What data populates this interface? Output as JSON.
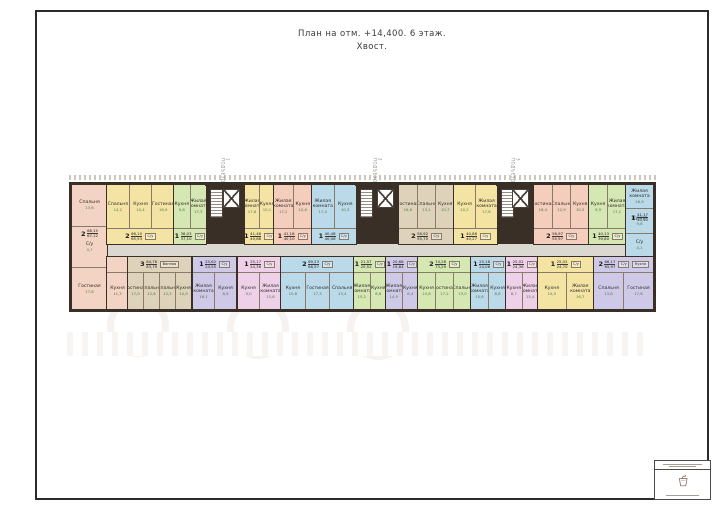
{
  "page": {
    "title_line1": "План на отм. +14,400. 6 этаж.",
    "title_line2": "Хвост."
  },
  "colors": {
    "wall": "#3a2f27",
    "partition": "#8a7a6a",
    "corridor": "#dbd8d2",
    "lobby": "#e7e4de",
    "pink": "#f3d3c3",
    "salmon": "#f4cdbc",
    "yellow": "#f4e4a4",
    "green": "#d5e7b2",
    "blue": "#bad9e9",
    "tan": "#ded3ba",
    "lavender": "#cfc9e8",
    "magenta": "#eed1e9"
  },
  "building": {
    "corridor": {
      "x": 35,
      "y": 59,
      "w": 521,
      "h": 13
    },
    "units": [
      {
        "t": "corner",
        "x": 0,
        "w": 35,
        "h": 124,
        "color": "pink",
        "ly": 44,
        "stack": [
          {
            "n": "Спальня",
            "a": "13,6"
          },
          {
            "n": "С/у",
            "a": "4,7"
          },
          {
            "n": "Гостиная",
            "a": "17,8"
          }
        ],
        "label": {
          "n": "2",
          "a1": "68,15",
          "a2": "67,12"
        }
      },
      {
        "t": "top",
        "x": 35,
        "w": 67,
        "color": "yellow",
        "rooms": [
          {
            "n": "Спальня",
            "a": "14,2"
          },
          {
            "n": "Кухня",
            "a": "10,4"
          },
          {
            "n": "Гостиная",
            "a": "16,9"
          }
        ],
        "chips": [
          "С/у"
        ],
        "label": {
          "n": "2",
          "a1": "66,10",
          "a2": "65,53"
        }
      },
      {
        "t": "top",
        "x": 102,
        "w": 32,
        "color": "green",
        "rooms": [
          {
            "n": "Кухня",
            "a": "9,8"
          },
          {
            "n": "Жилая комната",
            "a": "17,3"
          }
        ],
        "chips": [
          "С/у"
        ],
        "label": {
          "n": "1",
          "a1": "38,03",
          "a2": "37,10"
        }
      },
      {
        "t": "core",
        "x": 134,
        "w": 39,
        "entrance": "1 ПОДЪЕЗД"
      },
      {
        "t": "top",
        "x": 173,
        "w": 29,
        "color": "yellow",
        "rooms": [
          {
            "n": "Жилая комната",
            "a": "17,6"
          },
          {
            "n": "Кухня",
            "a": "10,1"
          }
        ],
        "chips": [
          "С/у"
        ],
        "label": {
          "n": "1",
          "a1": "41,46",
          "a2": "40,86"
        }
      },
      {
        "t": "top",
        "x": 202,
        "w": 38,
        "color": "salmon",
        "rooms": [
          {
            "n": "Жилая комната",
            "a": "17,2"
          },
          {
            "n": "Кухня",
            "a": "10,6"
          }
        ],
        "chips": [
          "С/у"
        ],
        "label": {
          "n": "1",
          "a1": "41,18",
          "a2": "40,10"
        }
      },
      {
        "t": "top",
        "x": 240,
        "w": 44,
        "color": "blue",
        "rooms": [
          {
            "n": "Жилая комната",
            "a": "17,4"
          },
          {
            "n": "Кухня",
            "a": "10,3"
          }
        ],
        "chips": [
          "С/у"
        ],
        "label": {
          "n": "1",
          "a1": "40,48",
          "a2": "40,06"
        }
      },
      {
        "t": "core",
        "x": 284,
        "w": 43,
        "entrance": "2 ПОДЪЕЗД"
      },
      {
        "t": "top",
        "x": 327,
        "w": 55,
        "color": "tan",
        "rooms": [
          {
            "n": "Гостиная",
            "a": "16,6"
          },
          {
            "n": "Спальня",
            "a": "13,1"
          },
          {
            "n": "Кухня",
            "a": "10,7"
          }
        ],
        "chips": [
          "С/у"
        ],
        "label": {
          "n": "2",
          "a1": "56,92",
          "a2": "55,70"
        }
      },
      {
        "t": "top",
        "x": 382,
        "w": 43,
        "color": "yellow",
        "rooms": [
          {
            "n": "Кухня",
            "a": "10,2"
          },
          {
            "n": "Жилая комната",
            "a": "17,8"
          }
        ],
        "chips": [
          "С/у"
        ],
        "label": {
          "n": "1",
          "a1": "40,86",
          "a2": "40,27"
        }
      },
      {
        "t": "core",
        "x": 425,
        "w": 37,
        "entrance": "3 ПОДЪЕЗД"
      },
      {
        "t": "top",
        "x": 462,
        "w": 55,
        "color": "salmon",
        "rooms": [
          {
            "n": "Гостиная",
            "a": "16,4"
          },
          {
            "n": "Спальня",
            "a": "12,9"
          },
          {
            "n": "Кухня",
            "a": "10,5"
          }
        ],
        "chips": [
          "С/у"
        ],
        "label": {
          "n": "2",
          "a1": "56,97",
          "a2": "55,97"
        }
      },
      {
        "t": "top",
        "x": 517,
        "w": 37,
        "color": "green",
        "rooms": [
          {
            "n": "Кухня",
            "a": "9,9"
          },
          {
            "n": "Жилая комната",
            "a": "17,1"
          }
        ],
        "chips": [
          "С/у"
        ],
        "label": {
          "n": "1",
          "a1": "40,13",
          "a2": "39,80"
        }
      },
      {
        "t": "corner",
        "x": 554,
        "w": 27,
        "h": 72,
        "color": "blue",
        "ly": 28,
        "stack": [
          {
            "n": "Жилая комната",
            "a": "16,9"
          },
          {
            "n": "Кухня",
            "a": "9,6"
          },
          {
            "n": "С/у",
            "a": "4,1"
          }
        ],
        "label": {
          "n": "1",
          "a1": "41,17",
          "a2": "40,90"
        }
      },
      {
        "t": "bottom",
        "x": 35,
        "w": 21,
        "color": "pink",
        "rooms": [
          {
            "n": "Кухня",
            "a": "11,3"
          }
        ]
      },
      {
        "t": "bottom",
        "x": 56,
        "w": 63,
        "color": "tan",
        "rooms": [
          {
            "n": "Гостиная",
            "a": "17,0"
          },
          {
            "n": "Спальня",
            "a": "12,6"
          },
          {
            "n": "Спальня",
            "a": "12,2"
          },
          {
            "n": "Кухня",
            "a": "10,9"
          }
        ],
        "chips": [
          "Ванная"
        ],
        "label": {
          "n": "3",
          "a1": "84,76",
          "a2": "83,79"
        }
      },
      {
        "t": "bottom",
        "x": 121,
        "w": 43,
        "color": "lavender",
        "rooms": [
          {
            "n": "Жилая комната",
            "a": "16,1"
          },
          {
            "n": "Кухня",
            "a": "8,9"
          }
        ],
        "chips": [
          "С/у"
        ],
        "label": {
          "n": "1",
          "a1": "25,62",
          "a2": "24,55"
        }
      },
      {
        "t": "bottom",
        "x": 166,
        "w": 43,
        "color": "magenta",
        "rooms": [
          {
            "n": "Кухня",
            "a": "9,0"
          },
          {
            "n": "Жилая комната",
            "a": "15,8"
          }
        ],
        "chips": [
          "С/у"
        ],
        "label": {
          "n": "1",
          "a1": "25,17",
          "a2": "24,36"
        }
      },
      {
        "t": "bottom",
        "x": 209,
        "w": 73,
        "color": "blue",
        "rooms": [
          {
            "n": "Кухня",
            "a": "10,8"
          },
          {
            "n": "Гостиная",
            "a": "17,3"
          },
          {
            "n": "Спальня",
            "a": "13,4"
          }
        ],
        "chips": [
          "С/у"
        ],
        "label": {
          "n": "2",
          "a1": "69,23",
          "a2": "68,57"
        }
      },
      {
        "t": "bottom",
        "x": 282,
        "w": 32,
        "color": "green",
        "rooms": [
          {
            "n": "Жилая комната",
            "a": "15,2"
          },
          {
            "n": "Кухня",
            "a": "8,6"
          }
        ],
        "chips": [
          "С/у"
        ],
        "label": {
          "n": "1",
          "a1": "21,57",
          "a2": "20,52"
        }
      },
      {
        "t": "bottom",
        "x": 314,
        "w": 32,
        "color": "lavender",
        "rooms": [
          {
            "n": "Жилая комната",
            "a": "14,9"
          },
          {
            "n": "Кухня",
            "a": "8,4"
          }
        ],
        "chips": [
          "С/у"
        ],
        "label": {
          "n": "1",
          "a1": "20,68",
          "a2": "19,84"
        }
      },
      {
        "t": "bottom",
        "x": 346,
        "w": 53,
        "color": "green",
        "rooms": [
          {
            "n": "Кухня",
            "a": "10,6"
          },
          {
            "n": "Гостиная",
            "a": "17,2"
          },
          {
            "n": "Спальня",
            "a": "13,0"
          }
        ],
        "chips": [
          "С/у"
        ],
        "label": {
          "n": "2",
          "a1": "74,28",
          "a2": "73,29"
        }
      },
      {
        "t": "bottom",
        "x": 399,
        "w": 35,
        "color": "blue",
        "rooms": [
          {
            "n": "Жилая комната",
            "a": "15,6"
          },
          {
            "n": "Кухня",
            "a": "8,8"
          }
        ],
        "chips": [
          "С/у"
        ],
        "label": {
          "n": "1",
          "a1": "25,18",
          "a2": "24,06"
        }
      },
      {
        "t": "bottom",
        "x": 434,
        "w": 32,
        "color": "magenta",
        "rooms": [
          {
            "n": "Кухня",
            "a": "8,7"
          },
          {
            "n": "Жилая комната",
            "a": "15,4"
          }
        ],
        "chips": [
          "С/у"
        ],
        "label": {
          "n": "1",
          "a1": "25,02",
          "a2": "24,36"
        }
      },
      {
        "t": "bottom",
        "x": 466,
        "w": 56,
        "color": "yellow",
        "rooms": [
          {
            "n": "Кухня",
            "a": "10,0"
          },
          {
            "n": "Жилая комната",
            "a": "16,7"
          }
        ],
        "chips": [
          "С/у"
        ],
        "label": {
          "n": "1",
          "a1": "25,02",
          "a2": "24,70"
        }
      },
      {
        "t": "bottom",
        "x": 522,
        "w": 59,
        "color": "lavender",
        "rooms": [
          {
            "n": "Спальня",
            "a": "13,8"
          },
          {
            "n": "Гостиная",
            "a": "17,6"
          }
        ],
        "chips": [
          "С/у",
          "Кухня"
        ],
        "label": {
          "n": "2",
          "a1": "66,17",
          "a2": "65,97"
        }
      }
    ]
  }
}
